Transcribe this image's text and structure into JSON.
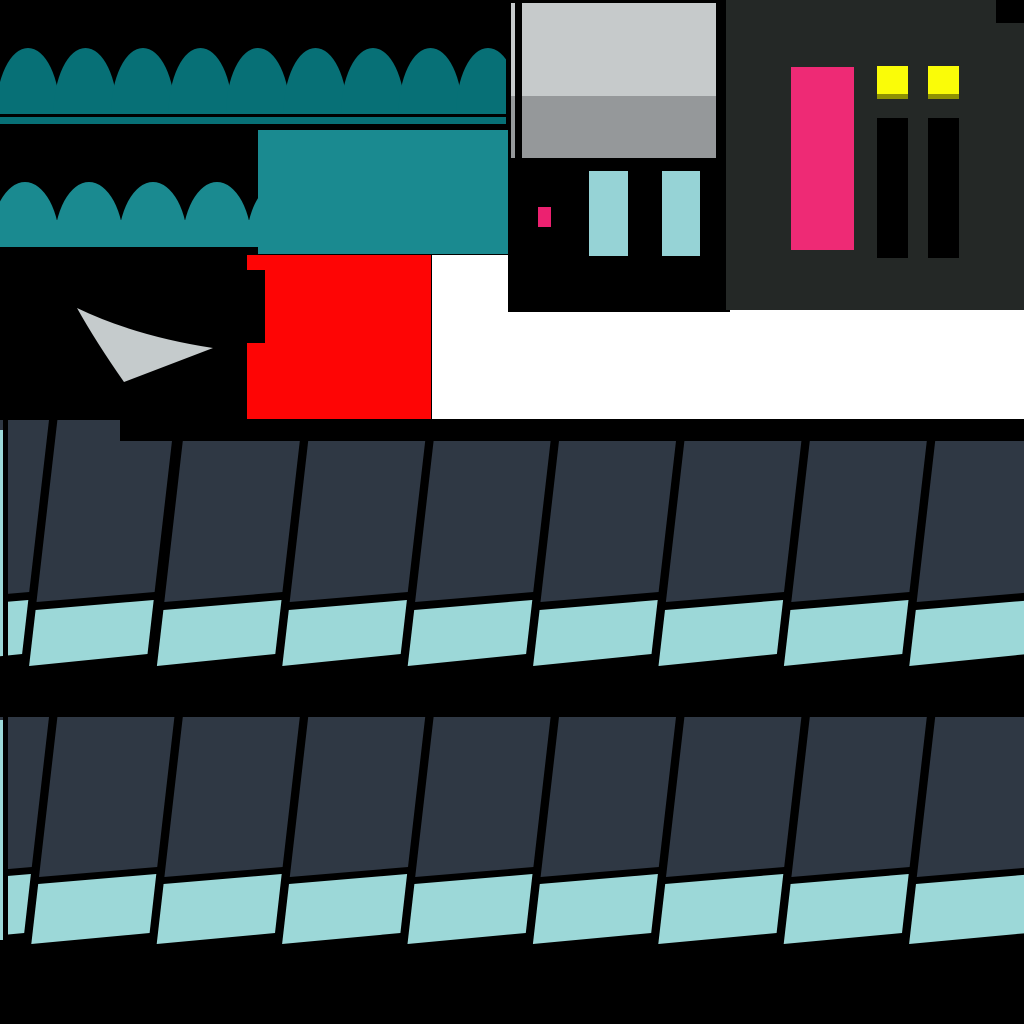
{
  "meta": {
    "width": 1024,
    "height": 1024,
    "background": "#000000"
  },
  "colors": {
    "background": "#000000",
    "white_backdrop": "#ffffff",
    "awning_dark_teal": "#077076",
    "awning_teal": "#1a8a90",
    "sign_teal": "#1a8a90",
    "red_block": "#fe0505",
    "window_glass_light": "#c6cacb",
    "window_glass_shade": "#95989a",
    "swoosh_gray": "#c5cbcc",
    "glass_cyan": "#96d3d6",
    "chip_pink": "#ec2170",
    "facade_charcoal": "#242826",
    "door_pink": "#ee2a75",
    "light_yellow": "#fafc08",
    "light_yellow_shade": "#8f9203",
    "slot_black": "#000000",
    "shingle_dark": "#2f3844",
    "shingle_cyan": "#9cd8d8"
  },
  "sprites": {
    "white_backdrop": {
      "x": 432,
      "y": 255,
      "w": 592,
      "h": 164
    },
    "storefront_shadow": {
      "x": 508,
      "y": 0,
      "w": 222,
      "h": 312
    },
    "facade_panel": {
      "x": 726,
      "y": 0,
      "w": 298,
      "h": 310
    },
    "facade_corner_cut": {
      "x": 996,
      "y": 0,
      "w": 28,
      "h": 23
    },
    "awning_rows": [
      {
        "name": "awning-row-1",
        "color_key": "awning_dark_teal",
        "clip": {
          "x": 0,
          "y": 0,
          "w": 506,
          "h": 130
        },
        "arch_count": 9,
        "cx0": 28,
        "pitch": 57.5,
        "rx": 32,
        "ry": 66,
        "base_y": 114,
        "fill_rect": {
          "x": 0,
          "y": 86,
          "w": 506,
          "h": 28
        }
      },
      {
        "name": "awning-row-2",
        "color_key": "awning_teal",
        "clip": {
          "x": 0,
          "y": 160,
          "w": 262,
          "h": 100
        },
        "arch_count": 5,
        "cx0": 25,
        "pitch": 64,
        "rx": 35,
        "ry": 65,
        "base_y": 247,
        "fill_rect": {
          "x": 0,
          "y": 220,
          "w": 262,
          "h": 27
        }
      }
    ],
    "awning_underline": {
      "x": 0,
      "y": 117,
      "w": 506,
      "h": 7
    },
    "sign_panel": {
      "x": 258,
      "y": 130,
      "w": 250,
      "h": 124
    },
    "red_block": {
      "x": 247,
      "y": 255,
      "w": 184,
      "h": 165
    },
    "red_notch": {
      "x": 247,
      "y": 270,
      "w": 18,
      "h": 73
    },
    "swoosh_path": "M 77 308 Q 135 336 213 348 L 124 382 Q 96 342 77 308 Z",
    "window": {
      "light": {
        "x": 511,
        "y": 2,
        "w": 207,
        "h": 94
      },
      "shade": {
        "x": 511,
        "y": 96,
        "w": 207,
        "h": 62
      },
      "top_line": {
        "x": 511,
        "y": 0,
        "w": 207,
        "h": 3
      },
      "mullions": [
        {
          "x": 515,
          "y": 0,
          "w": 7,
          "h": 158
        },
        {
          "x": 716,
          "y": 0,
          "w": 7,
          "h": 158
        }
      ]
    },
    "glass_bars": [
      {
        "x": 589,
        "y": 171,
        "w": 39,
        "h": 85
      },
      {
        "x": 662,
        "y": 171,
        "w": 38,
        "h": 85
      }
    ],
    "pink_chip": {
      "x": 538,
      "y": 207,
      "w": 13,
      "h": 20
    },
    "door_pink": {
      "x": 791,
      "y": 67,
      "w": 63,
      "h": 183
    },
    "lights_yellow": [
      {
        "x": 877,
        "y": 66,
        "w": 31,
        "h": 31
      },
      {
        "x": 928,
        "y": 66,
        "w": 31,
        "h": 31
      }
    ],
    "lights_shade": [
      {
        "x": 877,
        "y": 94,
        "w": 31,
        "h": 5
      },
      {
        "x": 928,
        "y": 94,
        "w": 31,
        "h": 5
      }
    ],
    "dark_slots": [
      {
        "x": 877,
        "y": 118,
        "w": 31,
        "h": 140
      },
      {
        "x": 928,
        "y": 118,
        "w": 31,
        "h": 140
      }
    ],
    "roof_backdrop": {
      "x": 0,
      "y": 419,
      "w": 1024,
      "h": 605
    },
    "roof_bands": [
      {
        "name": "roof-band-1",
        "x0": -68,
        "pitch": 125.4,
        "tile_w": 117,
        "count": 9,
        "slope": -0.115,
        "dark_top": 441,
        "dark_top_first": 420,
        "first_high_count": 2,
        "boundary_l": 602,
        "boundary_r": 592,
        "cyan_top_l": 610,
        "cyan_top_r": 600,
        "cyan_bot_l": 666,
        "cyan_bot_r": 654
      },
      {
        "name": "roof-band-2",
        "x0": -68,
        "pitch": 125.4,
        "tile_w": 117,
        "count": 9,
        "slope": -0.115,
        "dark_top": 717,
        "boundary_l": 877,
        "boundary_r": 867,
        "cyan_top_l": 884,
        "cyan_top_r": 874,
        "cyan_bot_l": 944,
        "cyan_bot_r": 933
      }
    ],
    "roof_cover_strip": {
      "x": 120,
      "y": 419,
      "w": 904,
      "h": 22
    },
    "edge_strips": [
      {
        "kind": "cyan",
        "x": 0,
        "y": 430,
        "w": 4,
        "h": 225
      },
      {
        "kind": "black",
        "x": 3,
        "y": 419,
        "w": 5,
        "h": 250
      },
      {
        "kind": "cyan",
        "x": 0,
        "y": 720,
        "w": 4,
        "h": 220
      },
      {
        "kind": "black",
        "x": 3,
        "y": 717,
        "w": 5,
        "h": 228
      }
    ]
  }
}
